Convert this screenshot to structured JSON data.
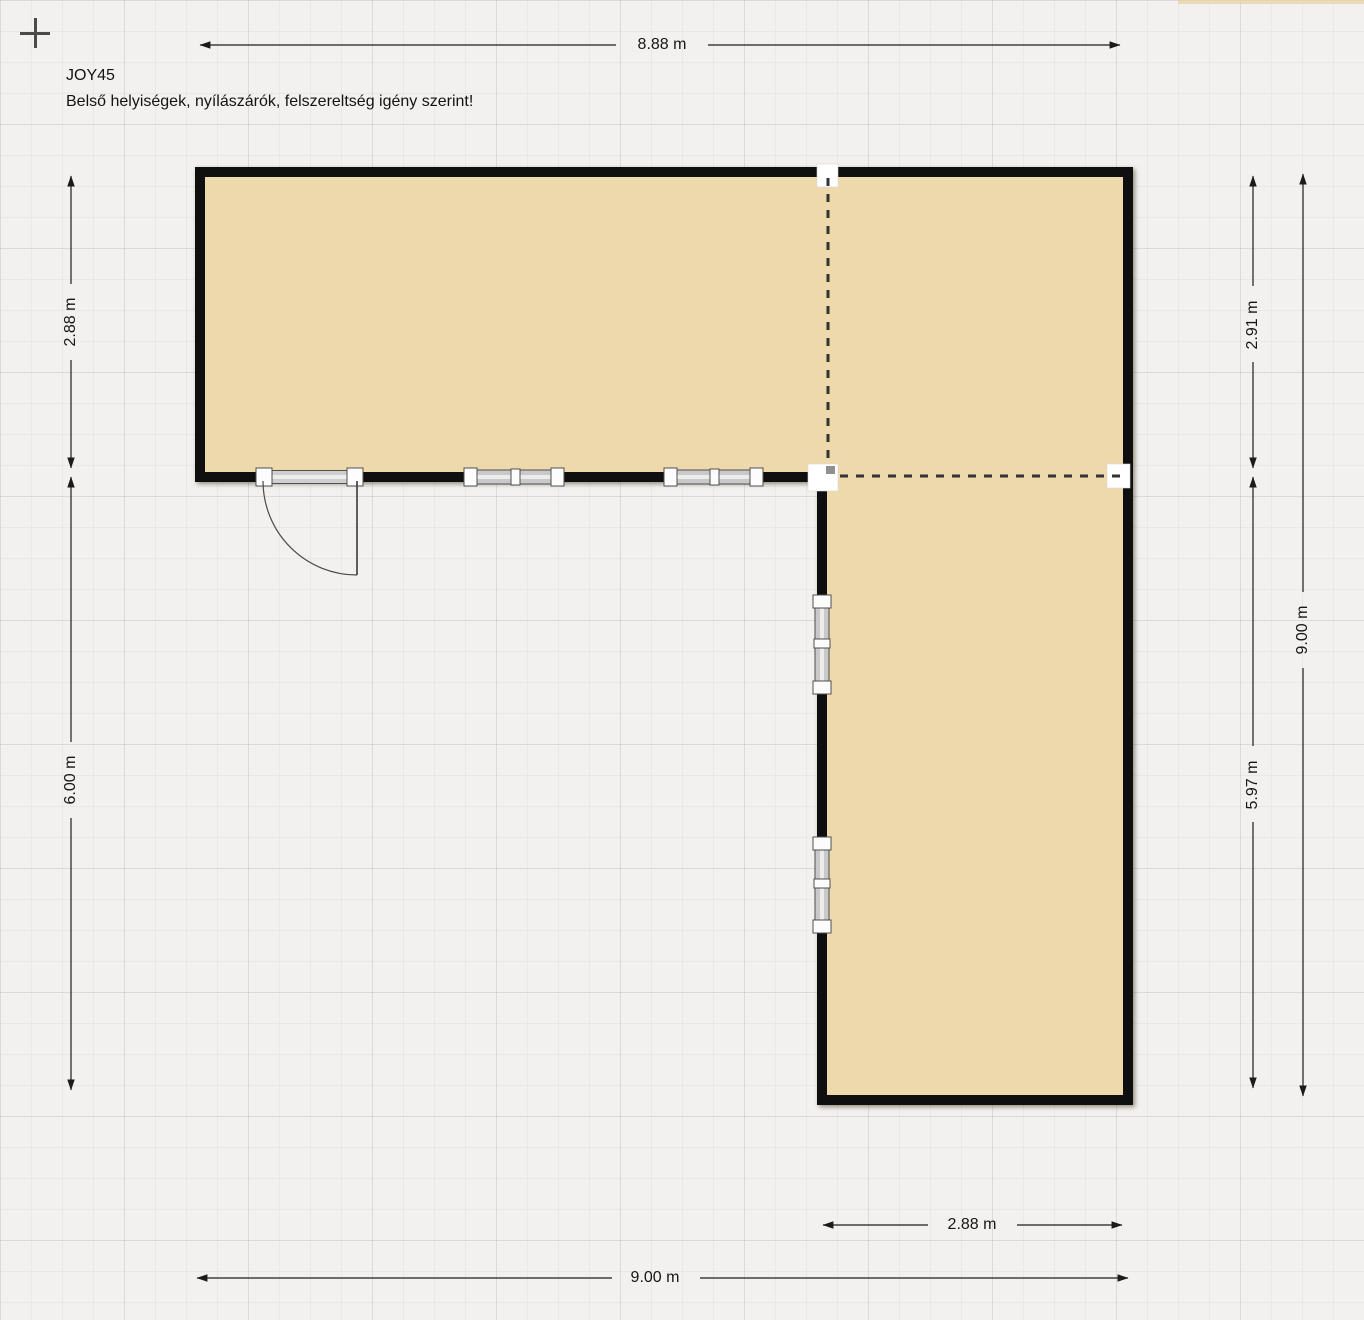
{
  "plan": {
    "title": "JOY45",
    "subtitle": "Belső helyiségek, nyílászárók, felszereltség igény szerint!"
  },
  "dimensions": {
    "top_width": "8.88 m",
    "left_upper_height": "2.88 m",
    "left_lower_height": "6.00 m",
    "right_upper_height": "2.91 m",
    "right_lower_height": "5.97 m",
    "right_total_height": "9.00 m",
    "bottom_wing_width": "2.88 m",
    "bottom_total_width": "9.00 m"
  },
  "icons": {
    "origin_crosshair": "+"
  },
  "colors": {
    "canvas_background": "#f2f1ef",
    "floor_fill": "#edd9ab",
    "wall": "#0f0f0f",
    "dimension_line": "#1d1d1d",
    "divider_dash": "#333333"
  }
}
